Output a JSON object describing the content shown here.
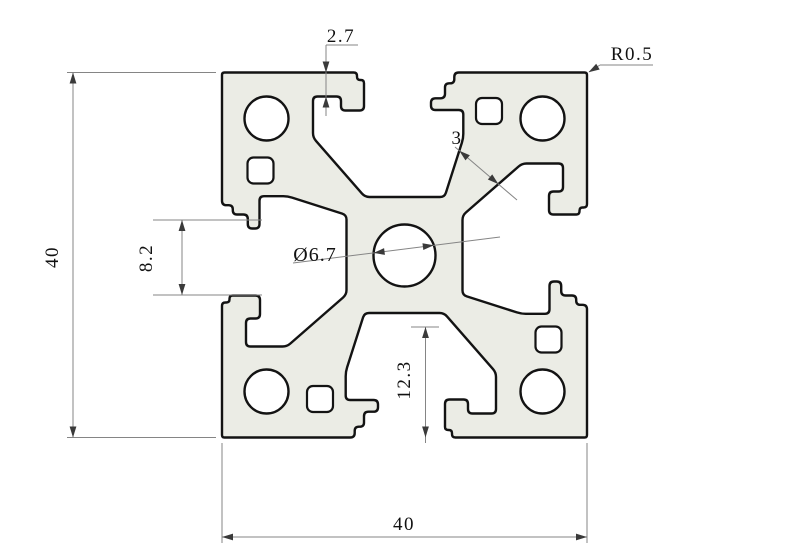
{
  "title": "4040 aluminum extrusion profile cross-section drawing",
  "dimensions": {
    "lip_depth": "2.7",
    "corner_radius": "R0.5",
    "wall_thickness": "3",
    "center_hole_diameter": "Ø6.7",
    "slot_opening": "8.2",
    "slot_depth": "12.3",
    "overall_width": "40",
    "overall_height": "40"
  },
  "colors": {
    "background": "#ffffff",
    "profile_fill": "#ebece5",
    "outline": "#131313",
    "dim_line": "#858585",
    "arrow": "#3a3a3a",
    "text": "#111111"
  }
}
